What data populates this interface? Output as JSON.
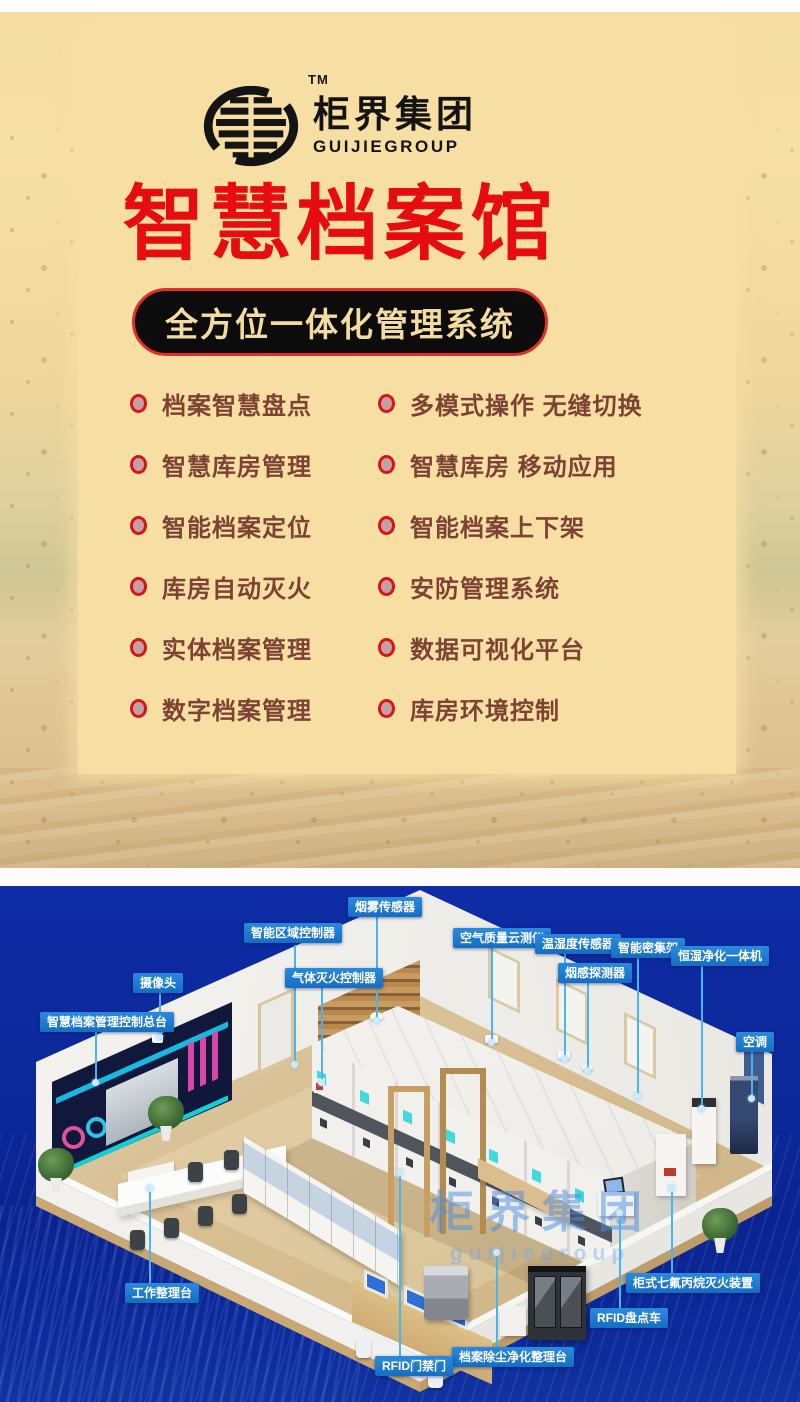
{
  "brand": {
    "name": "柜界集团",
    "name_en": "GUIJIEGROUP",
    "trademark": "TM"
  },
  "hero": {
    "title": "智慧档案馆",
    "subtitle": "全方位一体化管理系统"
  },
  "features": {
    "left": [
      "档案智慧盘点",
      "智慧库房管理",
      "智能档案定位",
      "库房自动灭火",
      "实体档案管理",
      "数字档案管理"
    ],
    "right": [
      "多模式操作 无缝切换",
      "智慧库房 移动应用",
      "智能档案上下架",
      "安防管理系统",
      "数据可视化平台",
      "库房环境控制"
    ]
  },
  "diagram": {
    "watermark": "柜界集团",
    "watermark_en": "guijiegroup",
    "callouts": [
      {
        "label": "烟雾传感器",
        "x": 348,
        "y": 11,
        "lx": 377,
        "y1": 31,
        "y2": 134,
        "dot": "end"
      },
      {
        "label": "智能区域控制器",
        "x": 244,
        "y": 37,
        "lx": 295,
        "y1": 59,
        "y2": 178,
        "dot": "end"
      },
      {
        "label": "空气质量云测仪",
        "x": 453,
        "y": 42,
        "lx": 492,
        "y1": 62,
        "y2": 156,
        "dot": "end"
      },
      {
        "label": "温湿度传感器",
        "x": 535,
        "y": 48,
        "lx": 565,
        "y1": 66,
        "y2": 172,
        "dot": "end"
      },
      {
        "label": "智能密集架",
        "x": 611,
        "y": 52,
        "lx": 638,
        "y1": 70,
        "y2": 210,
        "dot": "end"
      },
      {
        "label": "恒湿净化一体机",
        "x": 671,
        "y": 60,
        "lx": 702,
        "y1": 78,
        "y2": 222,
        "dot": "end"
      },
      {
        "label": "烟感探测器",
        "x": 558,
        "y": 77,
        "lx": 588,
        "y1": 95,
        "y2": 184,
        "dot": "end"
      },
      {
        "label": "气体灭火控制器",
        "x": 285,
        "y": 82,
        "lx": 322,
        "y1": 100,
        "y2": 196,
        "dot": "end"
      },
      {
        "label": "摄像头",
        "x": 133,
        "y": 87,
        "lx": 160,
        "y1": 105,
        "y2": 150,
        "dot": "end"
      },
      {
        "label": "智慧档案管理控制总台",
        "x": 40,
        "y": 126,
        "lx": 96,
        "y1": 144,
        "y2": 196,
        "dot": "end"
      },
      {
        "label": "空调",
        "x": 736,
        "y": 146,
        "lx": 752,
        "y1": 164,
        "y2": 212,
        "dot": "end"
      },
      {
        "label": "工作整理台",
        "x": 125,
        "y": 397,
        "lx": 150,
        "y1": 302,
        "y2": 397,
        "dot": "start"
      },
      {
        "label": "柜式七氟丙烷灭火装置",
        "x": 626,
        "y": 387,
        "lx": 672,
        "y1": 302,
        "y2": 387,
        "dot": "start"
      },
      {
        "label": "RFID盘点车",
        "x": 590,
        "y": 422,
        "lx": 620,
        "y1": 326,
        "y2": 422,
        "dot": "start"
      },
      {
        "label": "档案除尘净化整理台",
        "x": 452,
        "y": 461,
        "lx": 497,
        "y1": 366,
        "y2": 461,
        "dot": "start"
      },
      {
        "label": "RFID门禁门",
        "x": 375,
        "y": 470,
        "lx": 400,
        "y1": 286,
        "y2": 470,
        "dot": "start"
      }
    ]
  },
  "colors": {
    "accent_red": "#e60c10",
    "panel_cream": "#f7dfa4",
    "pill_text": "#f4dba0",
    "feature_text": "#7d4233",
    "callout_blue": "#1877d1",
    "deep_blue": "#0c2a9e",
    "leader_cyan": "#49b4ee"
  }
}
